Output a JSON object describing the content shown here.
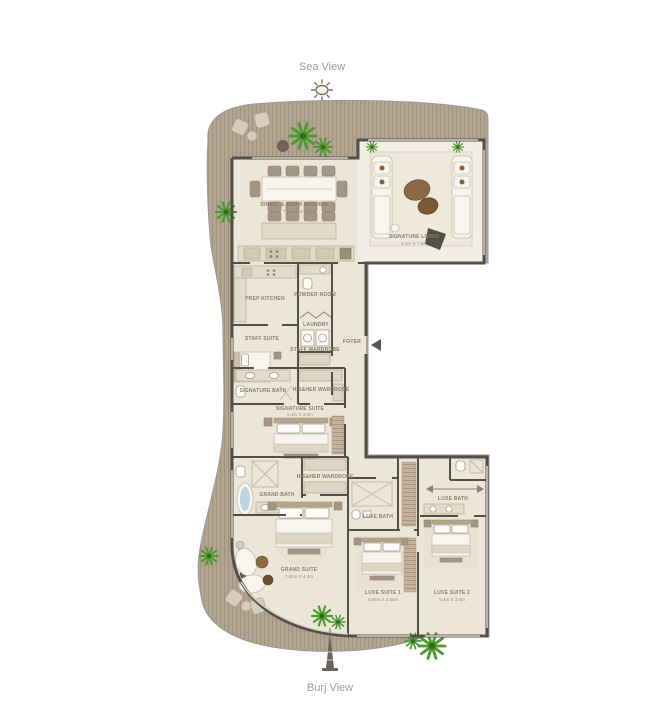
{
  "compass": {
    "sea_view_label": "Sea View",
    "burj_view_label": "Burj View",
    "sun_icon": "sun-icon",
    "burj_tower_icon": "burj-tower-icon"
  },
  "floorplan": {
    "rooms": {
      "dining": {
        "label": "DINING & SHOW KITCHEN",
        "dims": "7m X 8.8m"
      },
      "signature_living": {
        "label": "SIGNATURE LIVING",
        "dims": "8.4m X 7.5m"
      },
      "prep_kitchen": {
        "label": "PREP KITCHEN"
      },
      "powder_room": {
        "label": "POWDER ROOM"
      },
      "laundry": {
        "label": "LAUNDRY"
      },
      "foyer": {
        "label": "FOYER"
      },
      "staff_suite": {
        "label": "STAFF SUITE"
      },
      "staff_wardrobe": {
        "label": "STAFF WARDROBE"
      },
      "signature_bath": {
        "label": "SIGNATURE BATH"
      },
      "master_wardrobe": {
        "label": "HIS&HER WARDROBE"
      },
      "signature_suite": {
        "label": "SIGNATURE SUITE",
        "dims": "5.4m X 3.6m"
      },
      "grand_bath": {
        "label": "GRAND BATH"
      },
      "grand_wardrobe": {
        "label": "HIS&HER WARDROBE"
      },
      "grand_suite": {
        "label": "GRAND SUITE",
        "dims": "7.65m X 4.3m"
      },
      "luxe_bath_1": {
        "label": "LUXE BATH"
      },
      "luxe_bath_2": {
        "label": "LUXE BATH"
      },
      "luxe_suite_1": {
        "label": "LUXE SUITE 1",
        "dims": "4.55m X 3.55m"
      },
      "luxe_suite_2": {
        "label": "LUXE SUITE 2",
        "dims": "5.4m X 3.6m"
      }
    },
    "colors": {
      "deck": "#b3a492",
      "deck_stripe": "#a2937f",
      "wall": "#53504a",
      "floor": "#ece6d9",
      "living_floor": "#f3efe6",
      "plant_green": "#4e9a32",
      "water_blue": "#b9d6dc",
      "label_text": "#8d7c66",
      "view_text": "#9b9b9b"
    }
  }
}
